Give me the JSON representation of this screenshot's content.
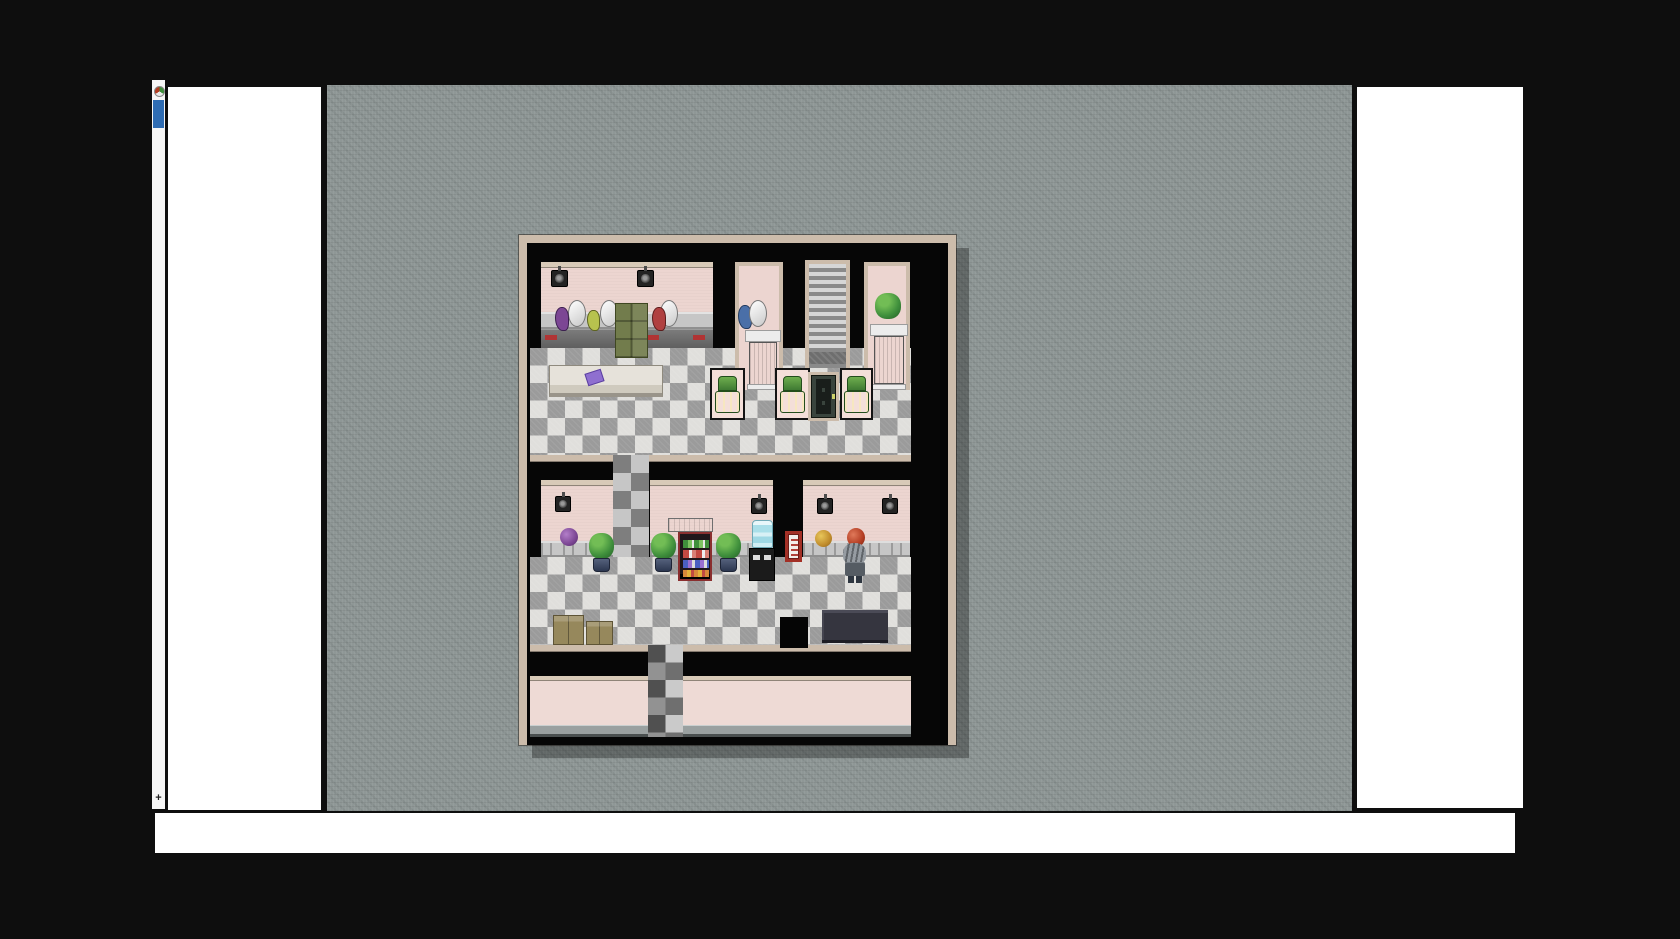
{
  "chrome": {
    "edge_strip": {
      "favicon": "game-favicon",
      "indicator": "blue-selection-indicator",
      "plus_glyph": "+"
    },
    "panels": {
      "left_blank": "",
      "right_blank": "",
      "bottom_blank": ""
    }
  },
  "scene": {
    "description": "RPG Maker style top-down interior map of a hair salon / barber shop with checkered tile floor",
    "palette": {
      "page_bg": "#0e0e0e",
      "panel": "#ffffff",
      "strip": "#f6f6f6",
      "accent_blue": "#2e6cb3",
      "canvas": "#8b9493",
      "tan": "#ccbcab",
      "tan_light": "#d8cab8",
      "room_black": "#060606",
      "pink": "#ecd5d0",
      "pink_ext": "#eedad5",
      "floor_light": "#e0dfdc",
      "floor_dark": "#9b9b9b",
      "counter_light": "#c6c6c6",
      "counter_dark": "#5f5f5f",
      "red_accent": "#b03434",
      "olive": "#727c4c",
      "panel_pink": "#f4dfd9",
      "chair_green": "#4f9a43",
      "door_green": "#39443d",
      "stair_light": "#d6d6d6",
      "stair_dark": "#8a8a8a",
      "bush_green": "#3f8f3c",
      "pot_navy": "#2c3750",
      "water_blue": "#aadfe9",
      "sign_red": "#a33026",
      "hair_gray": "#969ca2",
      "jacket_gray": "#555c63",
      "box_tan": "#96885c",
      "wall_base": "#9aa0a0",
      "book_purple": "#8f6fd0",
      "puff_purple": "#7c4694",
      "puff_yellow": "#c08c2c",
      "puff_orange": "#b23c22"
    },
    "elements": [
      {
        "name": "floor-upper-hall",
        "cls": "checker",
        "x": 3,
        "y": 105,
        "w": 381,
        "h": 112
      },
      {
        "name": "floor-lower-hall",
        "cls": "checker",
        "x": 3,
        "y": 314,
        "w": 381,
        "h": 88
      },
      {
        "name": "corridor-between-halls",
        "cls": "checker-dim",
        "x": 86,
        "y": 212,
        "w": 36,
        "h": 102
      },
      {
        "name": "divider-top-left",
        "cls": "tan",
        "x": 3,
        "y": 212,
        "w": 83,
        "h": 7
      },
      {
        "name": "divider-top-right",
        "cls": "tan",
        "x": 122,
        "y": 212,
        "w": 262,
        "h": 7
      },
      {
        "name": "divider-bottom-left",
        "cls": "tan",
        "x": 3,
        "y": 402,
        "w": 118,
        "h": 7
      },
      {
        "name": "divider-bottom-right",
        "cls": "tan",
        "x": 156,
        "y": 402,
        "w": 228,
        "h": 7
      },
      {
        "name": "exterior-front-wall",
        "x": 3,
        "y": 433,
        "w": 381,
        "h": 61,
        "children": [
          {
            "name": "exterior-trim",
            "cls": "tan-light",
            "x": 0,
            "y": 0,
            "w": 381,
            "h": 5
          },
          {
            "name": "exterior-wall-face",
            "cls": "pink-ext",
            "x": 0,
            "y": 5,
            "w": 381,
            "h": 44
          },
          {
            "name": "exterior-wall-base",
            "cls": "wall-base",
            "x": 0,
            "y": 49,
            "w": 381,
            "h": 9
          },
          {
            "name": "exterior-wall-edge",
            "cls": "dark-edge",
            "x": 0,
            "y": 58,
            "w": 381,
            "h": 3
          }
        ]
      },
      {
        "name": "corridor-exit-path",
        "cls": "checker-dark",
        "x": 121,
        "y": 402,
        "w": 35,
        "h": 92
      },
      {
        "name": "salon-room-wall",
        "x": 14,
        "y": 19,
        "w": 172,
        "h": 86,
        "children": [
          {
            "name": "salon-wall-trim",
            "cls": "tan-light",
            "x": 0,
            "y": 0,
            "w": 172,
            "h": 6
          },
          {
            "name": "salon-wall-face",
            "cls": "pink",
            "x": 0,
            "y": 6,
            "w": 172,
            "h": 44
          },
          {
            "name": "salon-counter-top",
            "cls": "counter-light",
            "x": 0,
            "y": 50,
            "w": 172,
            "h": 17
          },
          {
            "name": "salon-counter-front",
            "cls": "counter-dark",
            "x": 0,
            "y": 67,
            "w": 172,
            "h": 19
          },
          {
            "name": "counter-red-accent-1",
            "cls": "red",
            "x": 4,
            "y": 73,
            "w": 12,
            "h": 5
          },
          {
            "name": "counter-red-accent-2",
            "cls": "red",
            "x": 106,
            "y": 73,
            "w": 12,
            "h": 5
          },
          {
            "name": "counter-red-accent-3",
            "cls": "red",
            "x": 152,
            "y": 73,
            "w": 12,
            "h": 5
          }
        ]
      },
      {
        "name": "wall-speaker-icon",
        "cls": "speaker",
        "x": 24,
        "y": 27,
        "w": 17,
        "h": 17
      },
      {
        "name": "wall-speaker-icon",
        "cls": "speaker",
        "x": 110,
        "y": 27,
        "w": 17,
        "h": 17
      },
      {
        "name": "dryer-hood-1",
        "cls": "hood",
        "x": 41,
        "y": 57,
        "w": 18,
        "h": 27
      },
      {
        "name": "dryer-hood-2",
        "cls": "hood",
        "x": 73,
        "y": 57,
        "w": 18,
        "h": 27
      },
      {
        "name": "dryer-hood-3",
        "cls": "hood",
        "x": 133,
        "y": 57,
        "w": 18,
        "h": 27
      },
      {
        "name": "hair-dryer-purple",
        "cls": "dryer-purple",
        "x": 28,
        "y": 64,
        "w": 14,
        "h": 24
      },
      {
        "name": "hair-dryer-yellow",
        "cls": "dryer-yellow",
        "x": 60,
        "y": 67,
        "w": 13,
        "h": 21
      },
      {
        "name": "hair-dryer-red",
        "cls": "dryer-red",
        "x": 125,
        "y": 64,
        "w": 14,
        "h": 24
      },
      {
        "name": "green-cabinet",
        "cls": "cabinet",
        "x": 88,
        "y": 60,
        "w": 33,
        "h": 55
      },
      {
        "name": "booth-room-left",
        "cls": "framed",
        "x": 208,
        "y": 19,
        "w": 48,
        "h": 128,
        "children": [
          {
            "name": "pedestal-slab",
            "cls": "slab",
            "x": 6,
            "y": 64,
            "w": 36,
            "h": 12
          },
          {
            "name": "pedestal-column",
            "cls": "column",
            "x": 10,
            "y": 76,
            "w": 28,
            "h": 46
          },
          {
            "name": "pedestal-plinth",
            "cls": "slab",
            "x": 8,
            "y": 118,
            "w": 32,
            "h": 6
          }
        ]
      },
      {
        "name": "hair-dryer-blue",
        "cls": "dryer-blue",
        "x": 211,
        "y": 62,
        "w": 14,
        "h": 24
      },
      {
        "name": "dryer-hood-4",
        "cls": "hood",
        "x": 222,
        "y": 57,
        "w": 18,
        "h": 27
      },
      {
        "name": "staircase",
        "cls": "stairs",
        "x": 278,
        "y": 17,
        "w": 45,
        "h": 108,
        "children": [
          {
            "name": "stair-landing",
            "cls": "landing",
            "x": 0,
            "y": 88,
            "w": 37,
            "h": 12
          }
        ]
      },
      {
        "name": "booth-room-right",
        "cls": "framed",
        "x": 337,
        "y": 19,
        "w": 46,
        "h": 128,
        "children": [
          {
            "name": "pedestal-slab",
            "cls": "slab",
            "x": 2,
            "y": 58,
            "w": 38,
            "h": 12
          },
          {
            "name": "pedestal-column",
            "cls": "column",
            "x": 6,
            "y": 70,
            "w": 30,
            "h": 48
          },
          {
            "name": "pedestal-plinth",
            "cls": "slab",
            "x": 4,
            "y": 118,
            "w": 34,
            "h": 6
          }
        ]
      },
      {
        "name": "topiary-ball",
        "cls": "bush",
        "x": 348,
        "y": 50,
        "w": 26,
        "h": 26
      },
      {
        "name": "massage-table",
        "cls": "table",
        "x": 22,
        "y": 122,
        "w": 114,
        "h": 32,
        "children": [
          {
            "name": "purple-book",
            "cls": "book",
            "x": 36,
            "y": 5,
            "w": 17,
            "h": 13
          }
        ]
      },
      {
        "name": "styling-chair-panel-1",
        "cls": "panel",
        "x": 183,
        "y": 125,
        "w": 35,
        "h": 52,
        "children": [
          {
            "name": "chair-back",
            "cls": "chair-back",
            "x": 6,
            "y": 6,
            "w": 19,
            "h": 15
          },
          {
            "name": "chair-seat",
            "cls": "chair-seat",
            "x": 3,
            "y": 21,
            "w": 25,
            "h": 22
          }
        ]
      },
      {
        "name": "styling-chair-panel-2",
        "cls": "panel",
        "x": 248,
        "y": 125,
        "w": 35,
        "h": 52,
        "children": [
          {
            "name": "chair-back",
            "cls": "chair-back",
            "x": 6,
            "y": 6,
            "w": 19,
            "h": 15
          },
          {
            "name": "chair-seat",
            "cls": "chair-seat",
            "x": 3,
            "y": 21,
            "w": 25,
            "h": 22
          }
        ]
      },
      {
        "name": "styling-chair-panel-3",
        "cls": "panel",
        "x": 313,
        "y": 125,
        "w": 33,
        "h": 52,
        "children": [
          {
            "name": "chair-back",
            "cls": "chair-back",
            "x": 5,
            "y": 6,
            "w": 19,
            "h": 15
          },
          {
            "name": "chair-seat",
            "cls": "chair-seat",
            "x": 2,
            "y": 21,
            "w": 25,
            "h": 22
          }
        ]
      },
      {
        "name": "green-door",
        "cls": "door",
        "x": 281,
        "y": 129,
        "w": 31,
        "h": 49
      },
      {
        "name": "lower-left-room-wall",
        "x": 14,
        "y": 237,
        "w": 72,
        "h": 77,
        "children": [
          {
            "name": "wall-trim",
            "cls": "tan-light",
            "x": 0,
            "y": 0,
            "w": 72,
            "h": 6
          },
          {
            "name": "wall-face",
            "cls": "pink",
            "x": 0,
            "y": 6,
            "w": 72,
            "h": 55
          },
          {
            "name": "wall-counter",
            "cls": "counter-btn",
            "x": 0,
            "y": 61,
            "w": 72,
            "h": 16
          }
        ]
      },
      {
        "name": "lower-mid-room-wall",
        "x": 123,
        "y": 237,
        "w": 123,
        "h": 77,
        "children": [
          {
            "name": "wall-trim",
            "cls": "tan-light",
            "x": 0,
            "y": 0,
            "w": 123,
            "h": 6
          },
          {
            "name": "wall-face",
            "cls": "pink",
            "x": 0,
            "y": 6,
            "w": 123,
            "h": 55
          },
          {
            "name": "wall-counter",
            "cls": "counter-btn",
            "x": 0,
            "y": 61,
            "w": 123,
            "h": 16
          }
        ]
      },
      {
        "name": "lower-right-room-wall",
        "x": 276,
        "y": 237,
        "w": 107,
        "h": 77,
        "children": [
          {
            "name": "wall-trim",
            "cls": "tan-light",
            "x": 0,
            "y": 0,
            "w": 107,
            "h": 6
          },
          {
            "name": "wall-face",
            "cls": "pink",
            "x": 0,
            "y": 6,
            "w": 107,
            "h": 55
          },
          {
            "name": "wall-counter",
            "cls": "counter-btn",
            "x": 0,
            "y": 61,
            "w": 107,
            "h": 16
          }
        ]
      },
      {
        "name": "wall-speaker-icon",
        "cls": "speaker",
        "x": 28,
        "y": 253,
        "w": 16,
        "h": 16
      },
      {
        "name": "wall-speaker-icon",
        "cls": "speaker",
        "x": 224,
        "y": 255,
        "w": 16,
        "h": 16
      },
      {
        "name": "wall-speaker-icon",
        "cls": "speaker",
        "x": 290,
        "y": 255,
        "w": 16,
        "h": 16
      },
      {
        "name": "wall-speaker-icon",
        "cls": "speaker",
        "x": 355,
        "y": 255,
        "w": 16,
        "h": 16
      },
      {
        "name": "wig-ball-purple",
        "cls": "puff-purple",
        "x": 33,
        "y": 285,
        "w": 18,
        "h": 18
      },
      {
        "name": "potted-plant",
        "x": 61,
        "y": 290,
        "w": 27,
        "h": 40,
        "children": [
          {
            "name": "plant-foliage",
            "cls": "bush",
            "x": 1,
            "y": 0,
            "w": 25,
            "h": 26
          },
          {
            "name": "plant-pot",
            "cls": "pot",
            "x": 5,
            "y": 25,
            "w": 17,
            "h": 14
          }
        ]
      },
      {
        "name": "potted-plant",
        "x": 123,
        "y": 290,
        "w": 27,
        "h": 40,
        "children": [
          {
            "name": "plant-foliage",
            "cls": "bush",
            "x": 1,
            "y": 0,
            "w": 25,
            "h": 26
          },
          {
            "name": "plant-pot",
            "cls": "pot",
            "x": 5,
            "y": 25,
            "w": 17,
            "h": 14
          }
        ]
      },
      {
        "name": "potted-plant",
        "x": 188,
        "y": 290,
        "w": 27,
        "h": 40,
        "children": [
          {
            "name": "plant-foliage",
            "cls": "bush",
            "x": 1,
            "y": 0,
            "w": 25,
            "h": 26
          },
          {
            "name": "plant-pot",
            "cls": "pot",
            "x": 5,
            "y": 25,
            "w": 17,
            "h": 14
          }
        ]
      },
      {
        "name": "display-case-vent",
        "cls": "hood-vent",
        "x": 141,
        "y": 275,
        "w": 45,
        "h": 14
      },
      {
        "name": "food-display-case",
        "cls": "case",
        "x": 151,
        "y": 289,
        "w": 34,
        "h": 49,
        "children": [
          {
            "name": "shelf-salads",
            "cls": "shelf-a",
            "x": 3,
            "y": 6,
            "w": 26,
            "h": 8
          },
          {
            "name": "shelf-meats",
            "cls": "shelf-b",
            "x": 3,
            "y": 16,
            "w": 26,
            "h": 8
          },
          {
            "name": "shelf-packs",
            "cls": "shelf-c",
            "x": 3,
            "y": 26,
            "w": 26,
            "h": 8
          },
          {
            "name": "shelf-snacks",
            "cls": "shelf-d",
            "x": 3,
            "y": 36,
            "w": 26,
            "h": 7
          }
        ]
      },
      {
        "name": "water-cooler-bottle",
        "cls": "bottle",
        "x": 225,
        "y": 277,
        "w": 21,
        "h": 28
      },
      {
        "name": "water-cooler-body",
        "cls": "cooler",
        "x": 222,
        "y": 305,
        "w": 26,
        "h": 33
      },
      {
        "name": "red-wall-poster",
        "cls": "sign",
        "x": 258,
        "y": 288,
        "w": 17,
        "h": 31,
        "children": [
          {
            "name": "poster-print",
            "cls": "sign-marks",
            "x": 3,
            "y": 5,
            "w": 7,
            "h": 17
          }
        ]
      },
      {
        "name": "wig-ball-yellow",
        "cls": "puff-yellow",
        "x": 288,
        "y": 287,
        "w": 17,
        "h": 17
      },
      {
        "name": "wig-ball-orange",
        "cls": "puff-orange",
        "x": 320,
        "y": 285,
        "w": 18,
        "h": 19
      },
      {
        "name": "npc-gray-haired",
        "x": 315,
        "y": 300,
        "w": 25,
        "h": 40,
        "children": [
          {
            "name": "npc-hair",
            "cls": "hair",
            "x": 1,
            "y": 0,
            "w": 23,
            "h": 21
          },
          {
            "name": "npc-jacket",
            "cls": "jacket",
            "x": 3,
            "y": 19,
            "w": 20,
            "h": 14
          },
          {
            "name": "npc-leg",
            "cls": "legs",
            "x": 6,
            "y": 33,
            "w": 6,
            "h": 7
          },
          {
            "name": "npc-leg",
            "cls": "legs",
            "x": 14,
            "y": 33,
            "w": 6,
            "h": 7
          }
        ]
      },
      {
        "name": "reception-desk",
        "cls": "desk",
        "x": 295,
        "y": 367,
        "w": 66,
        "h": 33
      },
      {
        "name": "cardboard-box-large",
        "cls": "box",
        "x": 26,
        "y": 372,
        "w": 31,
        "h": 30
      },
      {
        "name": "cardboard-box-small",
        "cls": "box",
        "x": 59,
        "y": 378,
        "w": 27,
        "h": 24
      },
      {
        "name": "wall-stub",
        "cls": "black",
        "x": 253,
        "y": 374,
        "w": 28,
        "h": 31
      }
    ]
  }
}
